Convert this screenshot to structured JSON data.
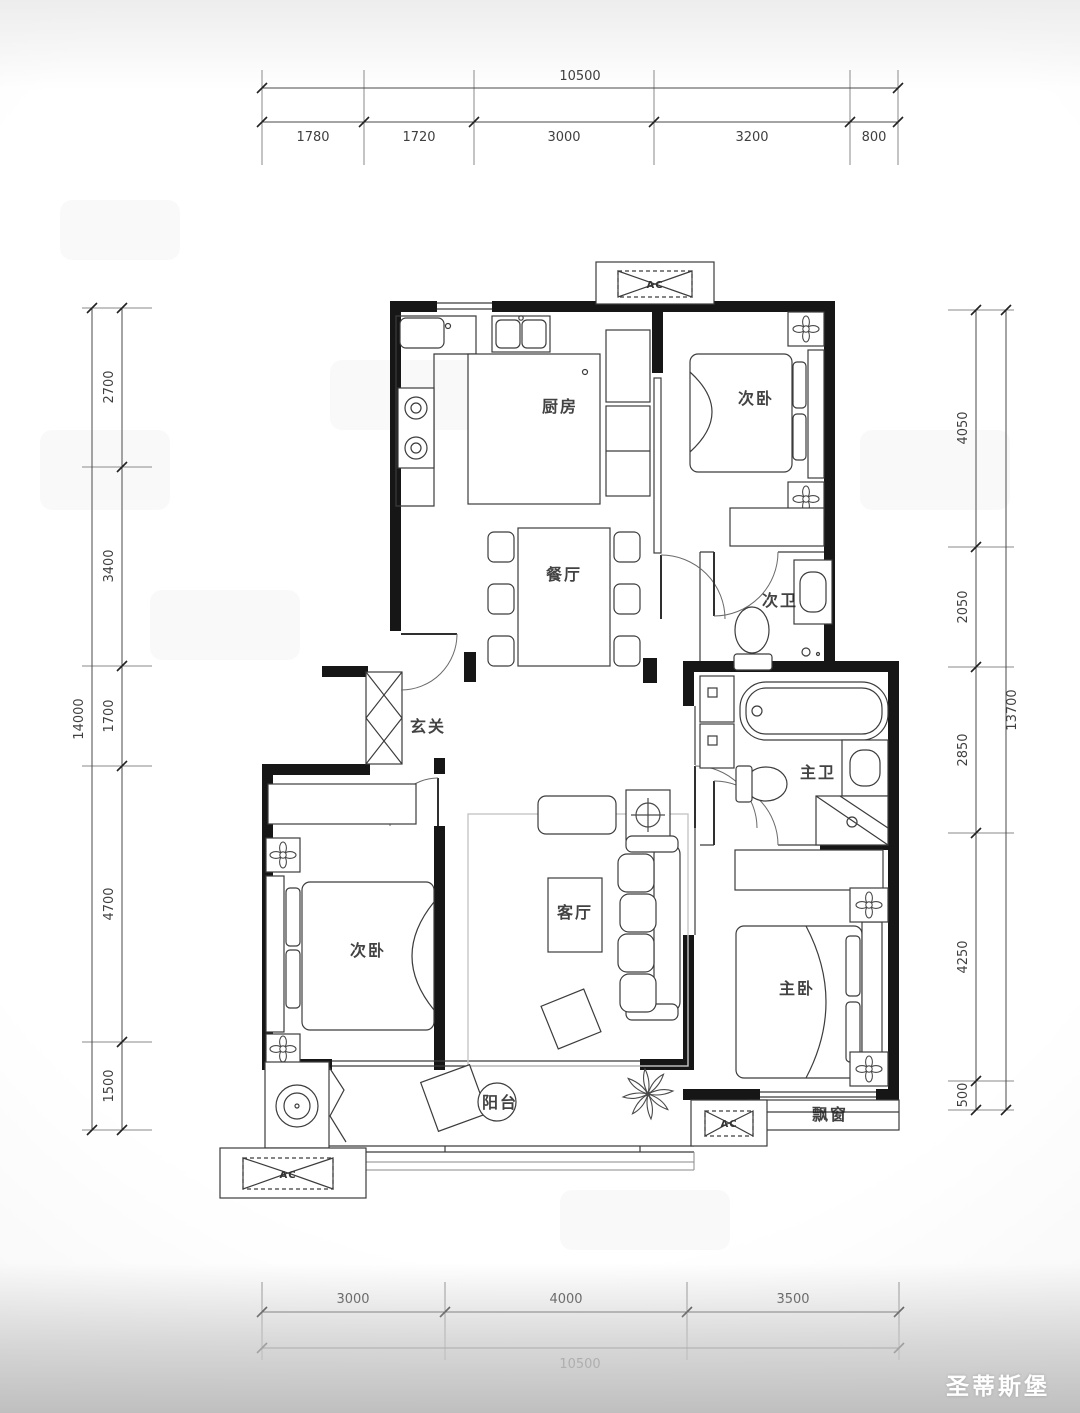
{
  "watermark": "圣蒂斯堡",
  "ac_label": "AC",
  "rooms": {
    "kitchen": "厨房",
    "bedroom2_top": "次卧",
    "dining": "餐厅",
    "bath2": "次卫",
    "entry": "玄关",
    "living": "客厅",
    "bath_master": "主卫",
    "bedroom2_left": "次卧",
    "bedroom_master": "主卧",
    "balcony": "阳台",
    "bay_window": "飘窗"
  },
  "dims": {
    "top": {
      "overall": "10500",
      "segments": [
        "1780",
        "1720",
        "3000",
        "3200",
        "800"
      ]
    },
    "bottom": {
      "overall": "10500",
      "segments": [
        "3000",
        "4000",
        "3500"
      ]
    },
    "left": {
      "overall": "14000",
      "segments": [
        "2700",
        "3400",
        "1700",
        "4700",
        "1500"
      ]
    },
    "right": {
      "overall": "13700",
      "segments": [
        "4050",
        "2050",
        "2850",
        "4250",
        "500"
      ]
    }
  }
}
